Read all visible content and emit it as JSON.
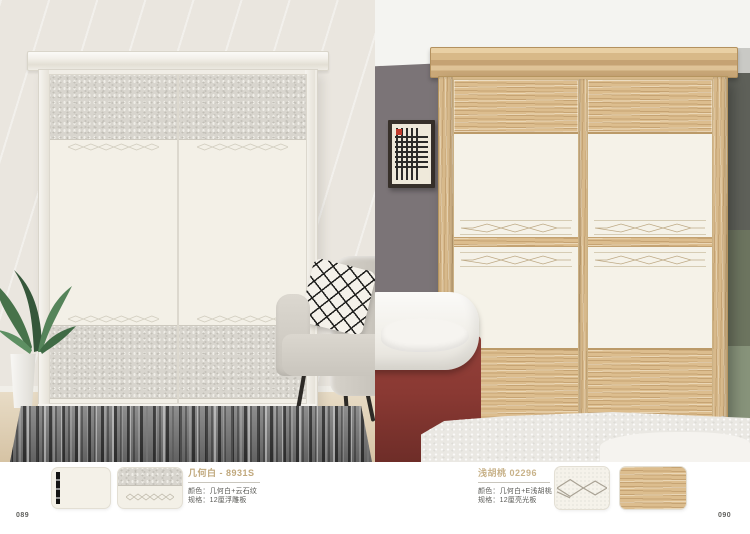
{
  "info": {
    "left": {
      "title": "几何白 - 8931S",
      "spec_line1": "颜色：几何白+云石纹",
      "spec_line2": "规格：12厘浮雕板",
      "page_number": "089"
    },
    "right": {
      "title": "浅胡桃 02296",
      "spec_line1": "颜色：几何白+E浅胡桃",
      "spec_line2": "规格：12厘亮光板",
      "page_number": "090"
    }
  },
  "swatches": {
    "left": [
      "white-door-with-handle",
      "stone-texture-with-diamond-pattern"
    ],
    "right": [
      "diamond-line-pattern",
      "light-oak-wood-grain"
    ]
  },
  "colors": {
    "title_accent": "#c0a87c",
    "spec_text": "#5a5a56",
    "left_wall": "#eae6df",
    "right_wall": "#7b7477",
    "wood": "#d7b98b",
    "bed_accent": "#8a3933",
    "texture_panel": "#d8d5ce"
  }
}
